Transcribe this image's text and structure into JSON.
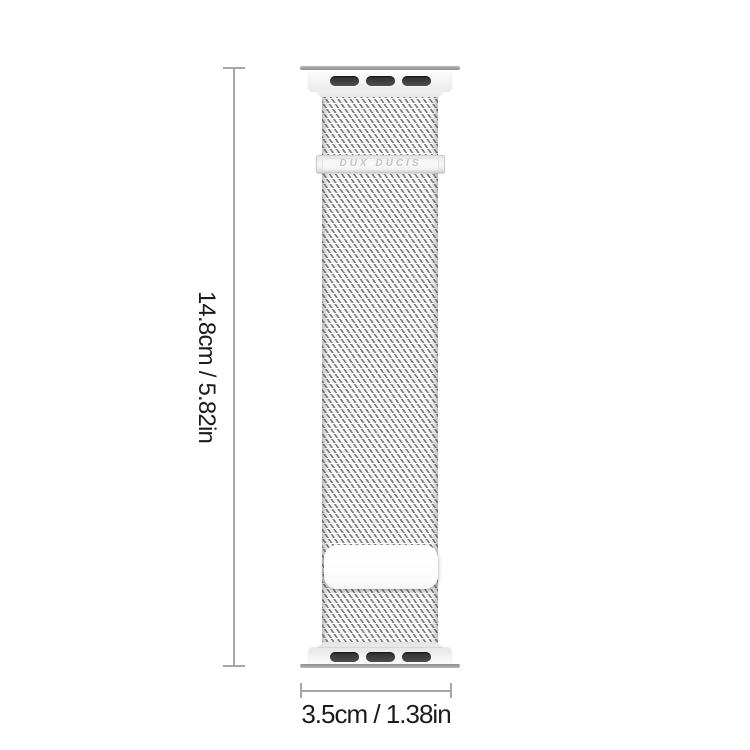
{
  "image": {
    "type": "product-dimension-diagram",
    "background": "#ffffff"
  },
  "product": {
    "name": "Milanese loop watch band with connector adapters",
    "brand_label": "DUX DUCIS",
    "colors": {
      "adapter_body": "#f2f2f2",
      "adapter_lug_bar": "#9b9b9b",
      "adapter_slot": "#3a3a3a",
      "mesh_base": "#f5f5f5",
      "mesh_weave": "#6e6e6e",
      "clasp": "#e9e9e9",
      "magnet_plate": "#ffffff"
    }
  },
  "dimensions": {
    "height_label": "14.8cm / 5.82in",
    "width_label": "3.5cm / 1.38in",
    "line_color": "#a6a6a6",
    "text_color": "#1c1c1c"
  }
}
